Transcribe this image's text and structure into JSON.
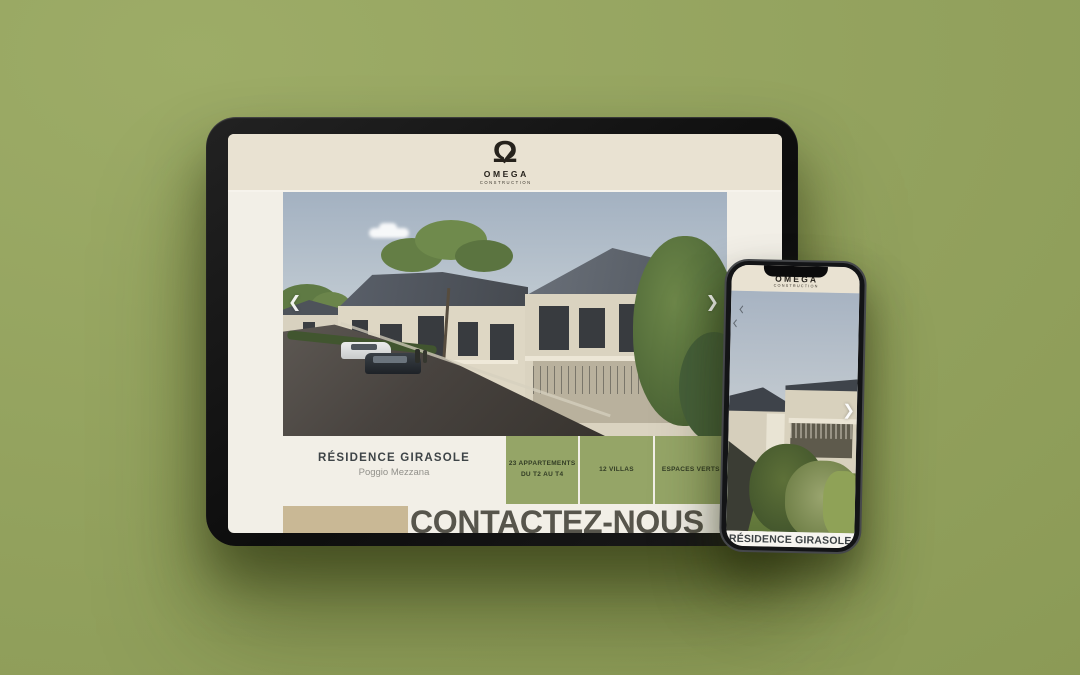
{
  "scene": {
    "description": "Responsive mockup of Omega Construction real-estate website shown on a tablet and a phone",
    "background_color": "#94a35f"
  },
  "tablet": {
    "header": {
      "logo_symbol": "Ω",
      "logo_name": "OMEGA",
      "logo_tagline": "CONSTRUCTION"
    },
    "carousel": {
      "prev_icon": "❮",
      "next_icon": "❯"
    },
    "project": {
      "title": "RÉSIDENCE GIRASOLE",
      "location": "Poggio Mezzana"
    },
    "features": [
      {
        "line1": "23 APPARTEMENTS",
        "line2": "DU T2 AU T4"
      },
      {
        "line1": "12 VILLAS",
        "line2": ""
      },
      {
        "line1": "ESPACES VERTS",
        "line2": ""
      }
    ],
    "cta": {
      "label": "CONTACTEZ-NOUS"
    }
  },
  "phone": {
    "header": {
      "logo_name": "OMEGA",
      "logo_tagline": "CONSTRUCTION"
    },
    "carousel": {
      "next_icon": "❯"
    },
    "caption": "RÉSIDENCE GIRASOLE"
  },
  "colors": {
    "background": "#94a35f",
    "header_cream": "#e9e2d2",
    "screen_white": "#f2efe7",
    "feature_green": "#95a567",
    "beige_block": "#c9b895",
    "cta_text": "#57554c",
    "title_text": "#3e4447",
    "location_text": "#92918b",
    "bezel_black": "#131416"
  }
}
